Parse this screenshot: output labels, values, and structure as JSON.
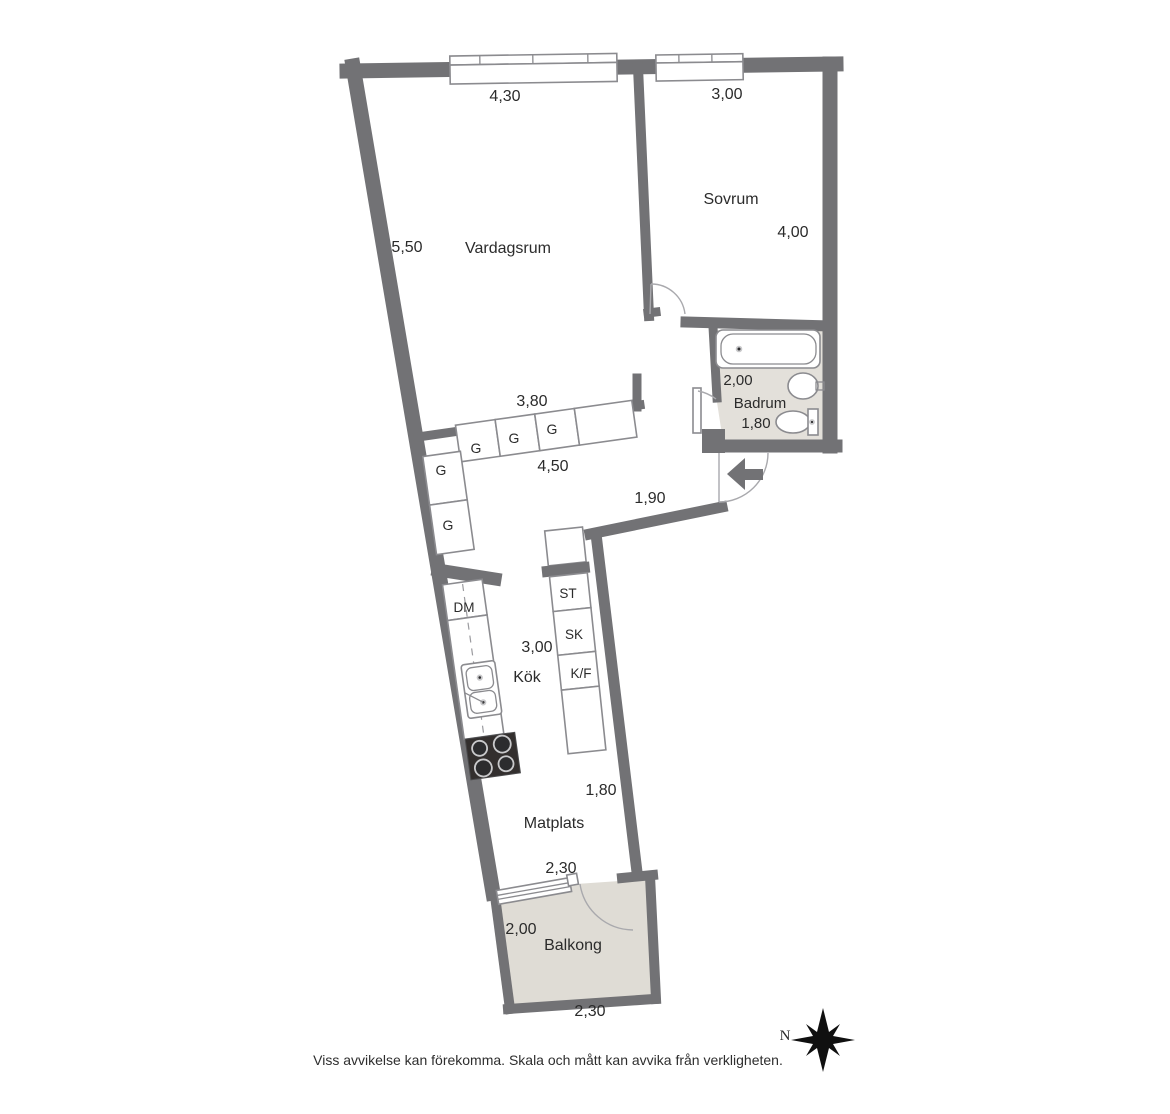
{
  "rooms": {
    "vardagsrum": {
      "name": "Vardagsrum",
      "width_top": "4,30",
      "height_left": "5,50"
    },
    "sovrum": {
      "name": "Sovrum",
      "width_top": "3,00",
      "height_right": "4,00"
    },
    "badrum": {
      "name": "Badrum",
      "width": "2,00",
      "depth": "1,80"
    },
    "hall": {
      "wall_bottom": "3,80",
      "width": "4,50",
      "entry_depth": "1,90"
    },
    "kok": {
      "name": "Kök",
      "length": "3,00"
    },
    "matplats": {
      "name": "Matplats",
      "width": "1,80",
      "balcony_wall": "2,30"
    },
    "balkong": {
      "name": "Balkong",
      "depth": "2,00",
      "width_bottom": "2,30"
    }
  },
  "closets": {
    "wardrobe": "G",
    "dishwasher": "DM",
    "storage": "ST",
    "cleaning": "SK",
    "fridge_freezer": "K/F"
  },
  "compass": {
    "north_label": "N"
  },
  "footer": {
    "disclaimer": "Viss avvikelse kan förekomma. Skala och mått kan avvika från verkligheten."
  },
  "colors": {
    "wall": "#727275",
    "bathroom_floor": "#e3e0da",
    "balcony_floor": "#dfdcd5",
    "stove": "#332f2e",
    "text": "#2b2b2b"
  }
}
